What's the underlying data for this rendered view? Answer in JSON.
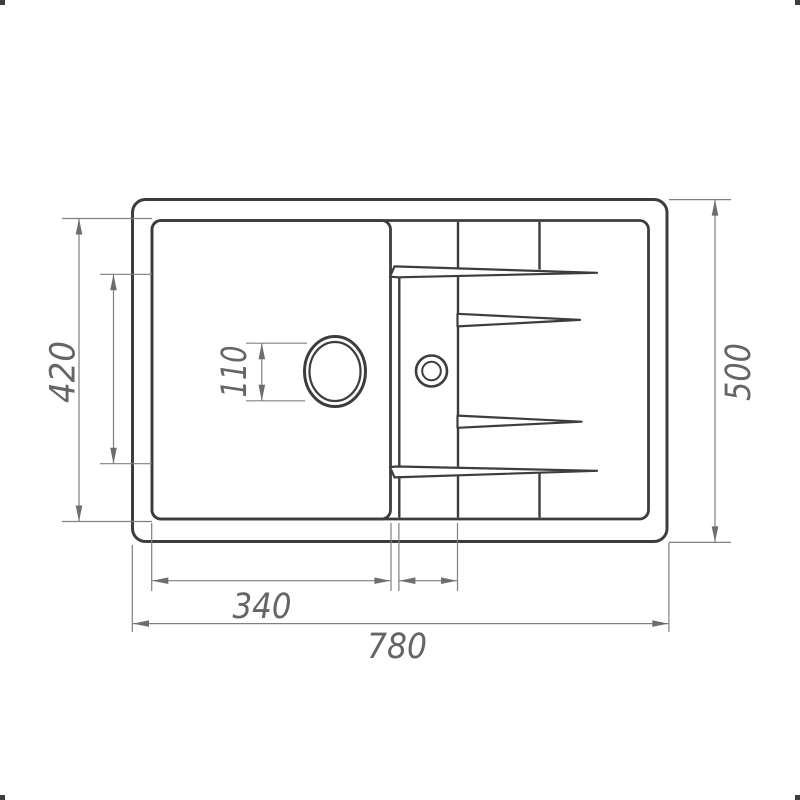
{
  "figure_type": "sink-top-view-dimensional-drawing",
  "colors": {
    "background": "#ffffff",
    "outline": "#3d3d3d",
    "dimension_line": "#808080",
    "arrow": "#6e6e6e",
    "label_text": "#656565"
  },
  "dimensions": {
    "overall_width": {
      "label": "780"
    },
    "overall_depth": {
      "label": "500"
    },
    "bowl_width": {
      "label": "340"
    },
    "bowl_depth": {
      "label": "420"
    },
    "drain_hole": {
      "label": "110"
    }
  }
}
